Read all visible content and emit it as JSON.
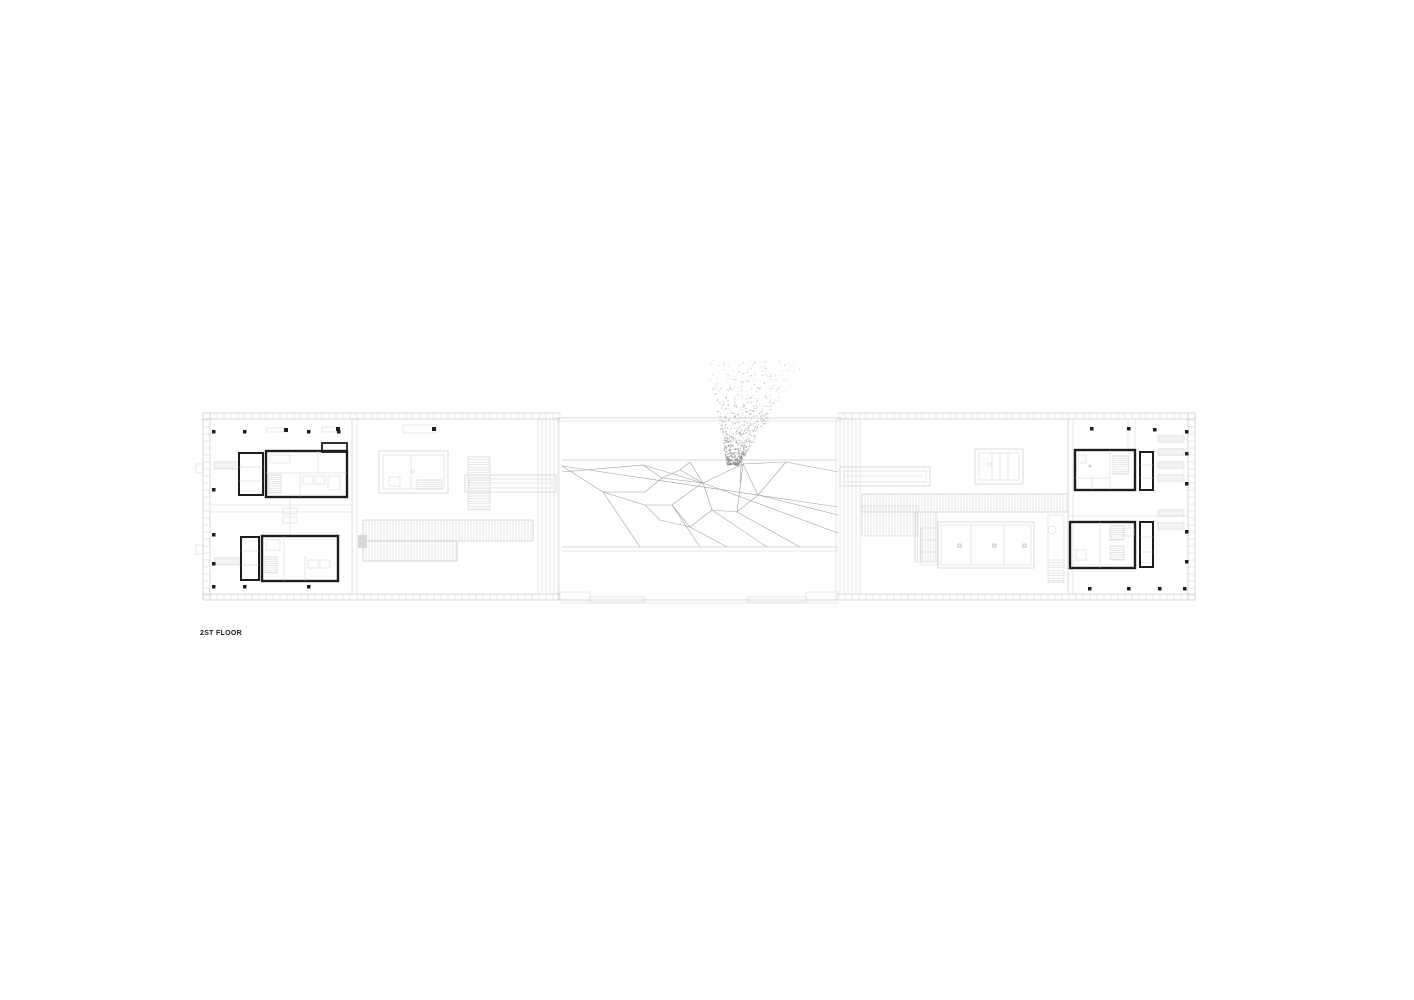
{
  "title": {
    "floor_label": "2ST FLOOR"
  },
  "colors": {
    "background": "#ffffff",
    "line_light": "#c7cacc",
    "line_mid": "#9ba0a3",
    "line_dark": "#1b1d1e",
    "fill_gray": "#d6d8d9"
  }
}
